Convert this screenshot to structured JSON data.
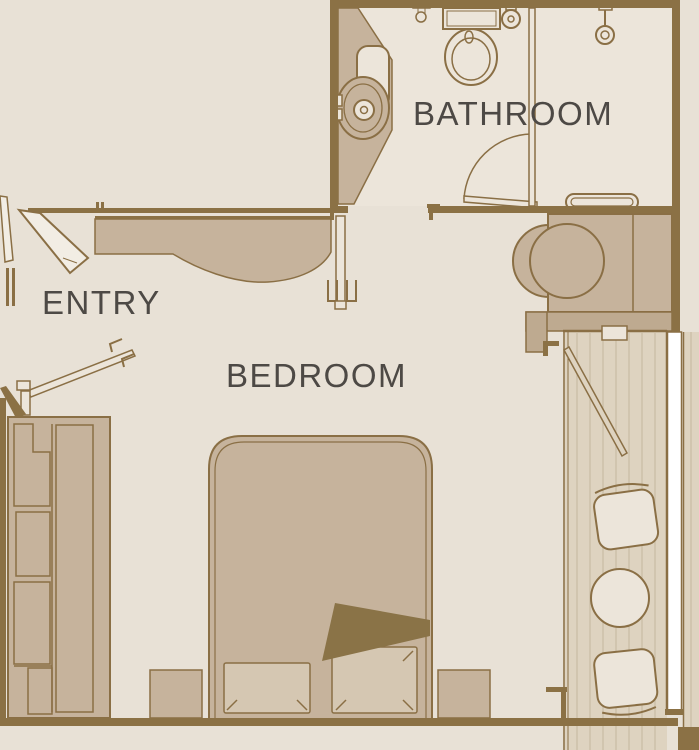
{
  "diagram_type": "stateroom-floor-plan",
  "rooms": {
    "bathroom": {
      "label": "BATHROOM"
    },
    "entry": {
      "label": "ENTRY"
    },
    "bedroom": {
      "label": "BEDROOM"
    }
  },
  "fixtures": [
    "toilet-icon",
    "toilet-paper-holder-icon",
    "wall-control-icon",
    "sink-icon",
    "vanity-counter",
    "vanity-mirror-icon",
    "shower-head-icon",
    "shower-grab-bar-icon",
    "bathroom-door-icon",
    "cabin-entry-door-icon",
    "bedroom-door-icon",
    "wardrobe-icon",
    "wardrobe-door-icon",
    "bed-icon",
    "pillow-icon",
    "blanket-fold-icon",
    "nightstand-left-icon",
    "nightstand-right-icon",
    "desk-icon",
    "desk-chair-icon",
    "desk-cabinet-icon",
    "balcony-door-icon",
    "balcony-deck",
    "balcony-railing",
    "balcony-chair-top-icon",
    "balcony-table-icon",
    "balcony-chair-bottom-icon"
  ],
  "palette": {
    "background": "#e8e1d6",
    "room_floor": "#ece5da",
    "furniture_tan": "#c6b39c",
    "furniture_tan_dark": "#beaa90",
    "wall_brown": "#8b7145",
    "outline_brown": "#8a6f45",
    "blanket_brown": "#8a7347",
    "pillow_fill": "#d5c7b2",
    "deck_fill": "#ded3c0",
    "deck_plank_line": "#c9bca4",
    "railing_white": "#ffffff",
    "label_text": "#4d4945"
  }
}
